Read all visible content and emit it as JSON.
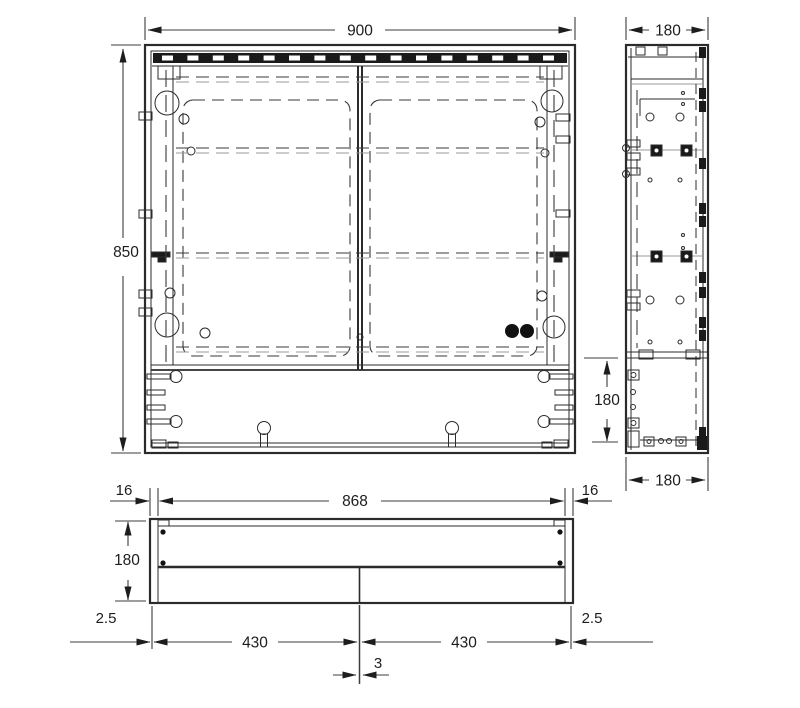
{
  "drawing": {
    "type": "cabinet technical drawing, three orthographic views",
    "colors": {
      "line": "#2b2b2b",
      "dim_line": "#3c3c3c",
      "hidden_line": "#9a9a9a",
      "background": "#ffffff",
      "fitting_fill": "#1a1a1a"
    }
  },
  "dims": {
    "front_width": "900",
    "front_height": "850",
    "front_lower_height": "180",
    "side_depth_top": "180",
    "side_depth_bottom": "180",
    "bottom_wall_left": "16",
    "bottom_inner_width": "868",
    "bottom_wall_right": "16",
    "bottom_depth": "180",
    "bottom_offset_left": "2.5",
    "bottom_door_left": "430",
    "bottom_center_gap": "3",
    "bottom_door_right": "430",
    "bottom_offset_right": "2.5"
  }
}
